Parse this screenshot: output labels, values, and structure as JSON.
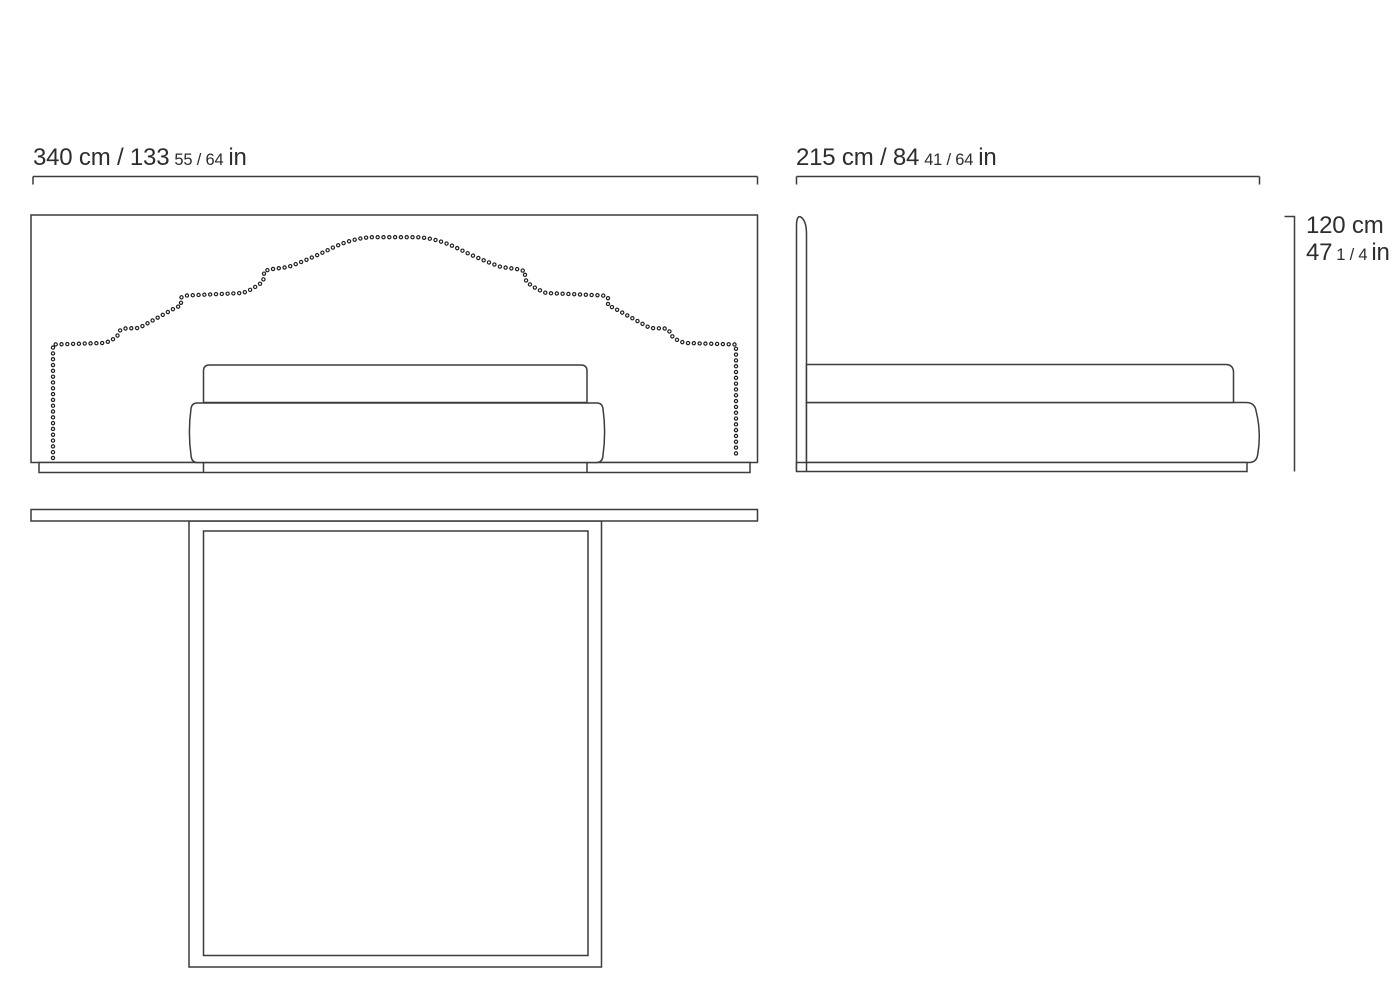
{
  "drawing": {
    "subject": "bed-technical-drawing",
    "views": {
      "front": "front-elevation",
      "side": "side-elevation",
      "top": "plan-view"
    }
  },
  "labels": {
    "front_width": {
      "main": "340 cm / 133",
      "fraction": "55 / 64",
      "unit": "in"
    },
    "side_depth": {
      "main": "215 cm / 84",
      "fraction": "41 / 64",
      "unit": "in"
    },
    "height": {
      "cm": "120 cm",
      "in_main": "47",
      "in_fraction": "1 / 4",
      "in_unit": "in"
    }
  },
  "colors": {
    "line": "#3c3c3c",
    "stud_dots": "#1e1e1e",
    "text": "#2d2d2d",
    "background": "#ffffff"
  }
}
